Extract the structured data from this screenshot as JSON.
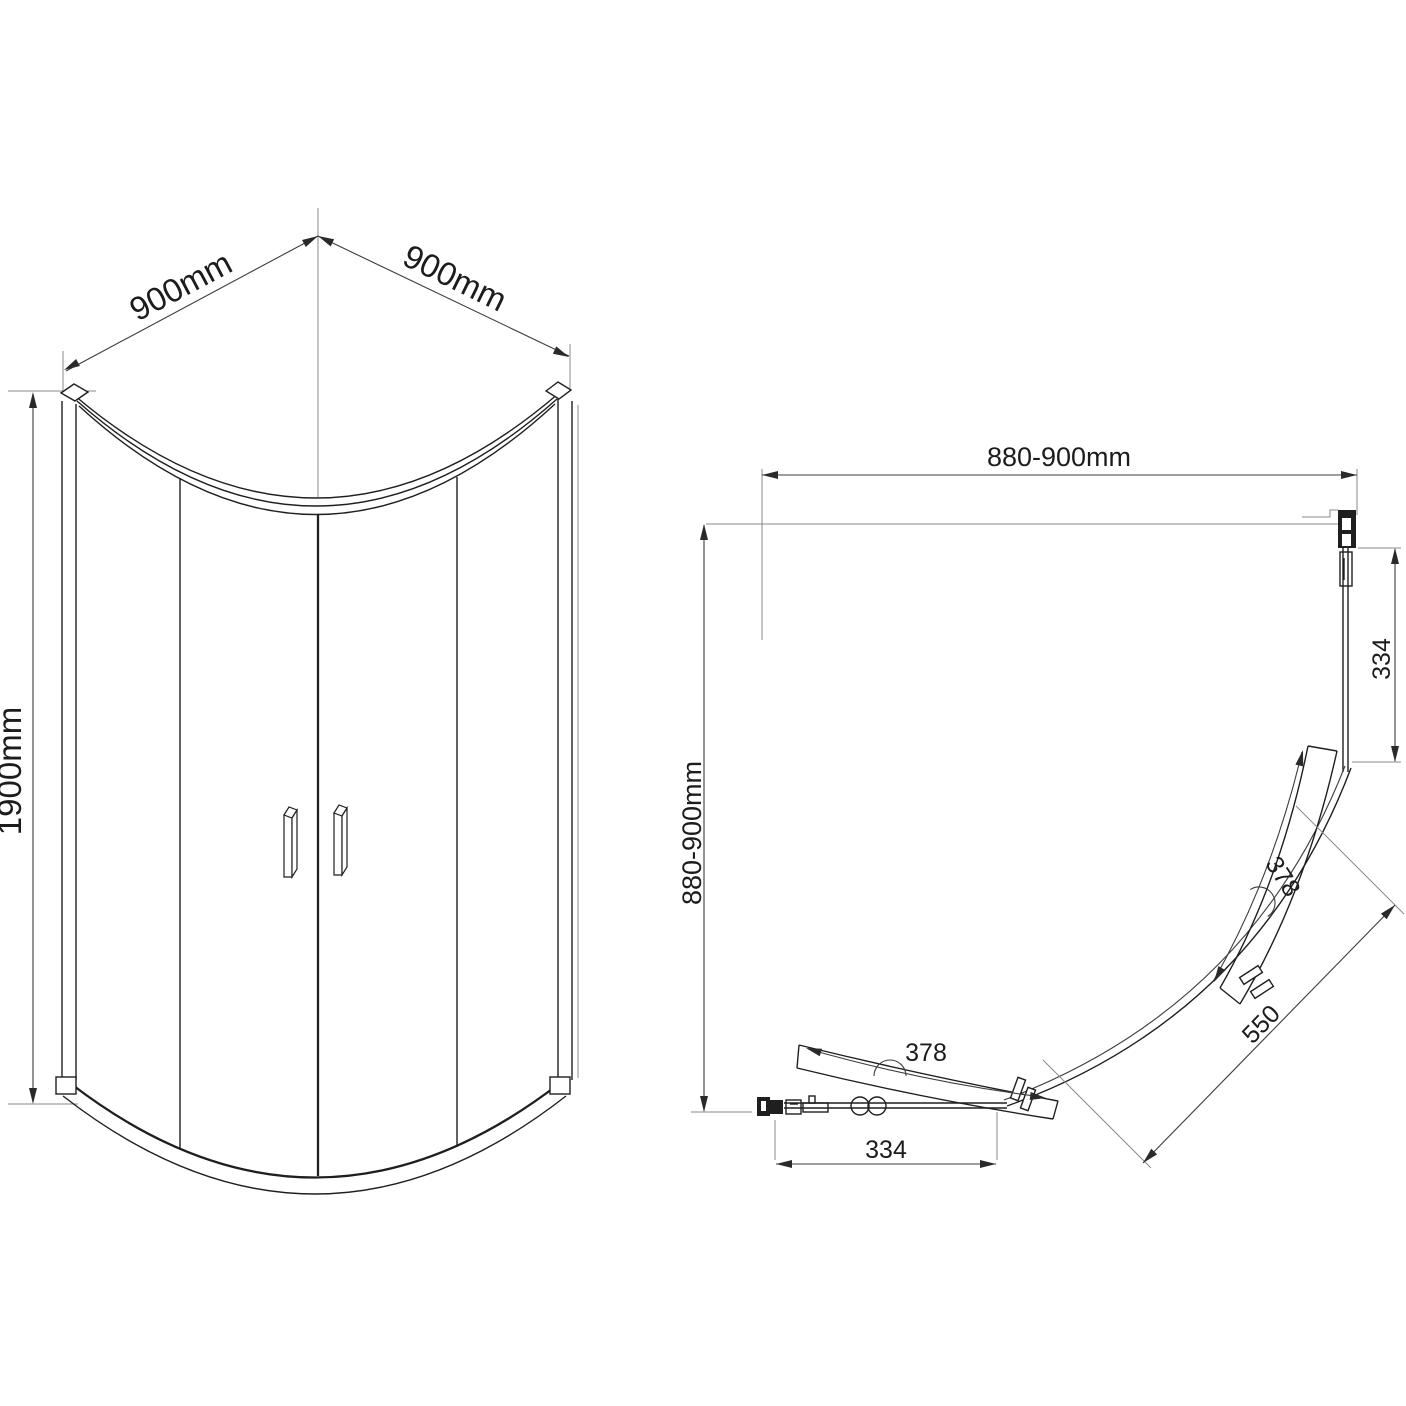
{
  "colors": {
    "background": "#ffffff",
    "line": "#1f1f1f",
    "dimension": "#3d3d3d"
  },
  "views": {
    "front": {
      "dims": {
        "width_left": "900mm",
        "width_right": "900mm",
        "height": "1900mm"
      }
    },
    "plan": {
      "dims": {
        "width_top": "880-900mm",
        "depth_left": "880-900mm",
        "fixed_right": "334",
        "fixed_bottom": "334",
        "door_upper": "378",
        "door_lower": "378",
        "opening": "550"
      }
    }
  }
}
